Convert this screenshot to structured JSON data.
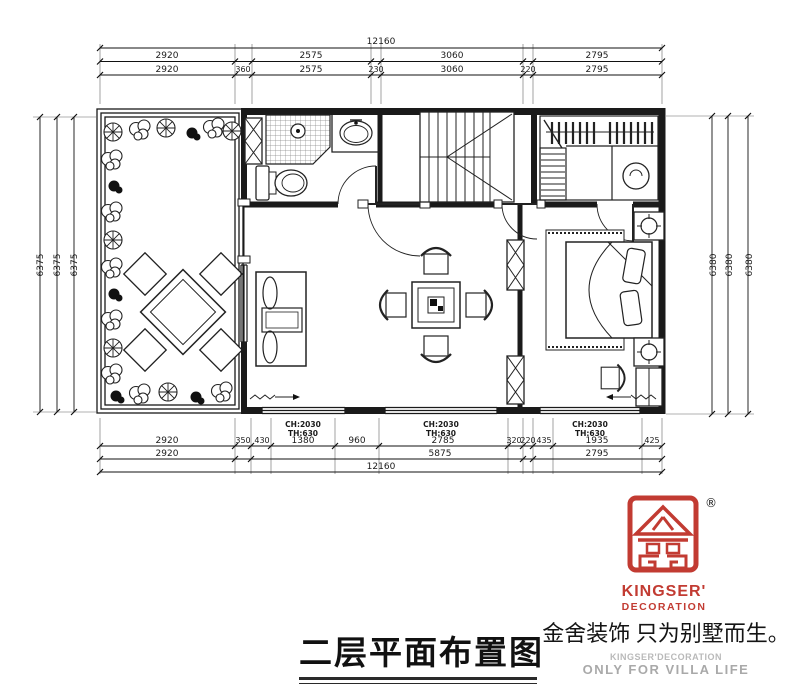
{
  "drawing": {
    "dims": {
      "top": {
        "total": "12160",
        "row2": [
          "2920",
          "2575",
          "3060",
          "2795"
        ],
        "row3": [
          "2920",
          "360",
          "2575",
          "230",
          "3060",
          "220",
          "2795"
        ]
      },
      "bottom": {
        "row1": [
          "2920",
          "350",
          "430",
          "1380",
          "960",
          "2785",
          "320",
          "220",
          "435",
          "1935",
          "425"
        ],
        "row2": [
          "2920",
          "5875",
          "2795"
        ],
        "total": "12160"
      },
      "left": [
        "6375",
        "6375",
        "6375"
      ],
      "right": [
        "6380",
        "6380",
        "6380"
      ]
    },
    "window_labels": [
      {
        "ch": "CH:2030",
        "th": "TH:630"
      },
      {
        "ch": "CH:2030",
        "th": "TH:630"
      },
      {
        "ch": "CH:2030",
        "th": "TH:630"
      }
    ]
  },
  "caption": {
    "title": "二层平面布置图",
    "slogan": "金舍装饰 只为别墅而生。",
    "brand_en": "KINGSER'DECORATION",
    "brand_tag": "ONLY FOR VILLA LIFE",
    "logo": {
      "reg": "®",
      "line1": "KINGSER'",
      "line2": "DECORATION",
      "color": "#c23b32"
    }
  },
  "colors": {
    "line": "#1a1a1a",
    "logo_red": "#c23b32",
    "gray_text": "#a9a9a9"
  }
}
